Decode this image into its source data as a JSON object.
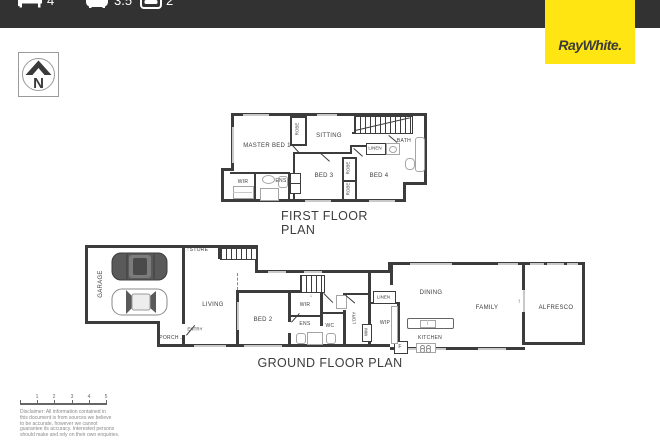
{
  "colors": {
    "top_bar": "#323232",
    "brand_yellow": "#ffe512",
    "brand_text": "#3b3b3b",
    "wall": "#3c3c3c"
  },
  "header": {
    "stats": [
      {
        "icon": "bed-icon",
        "value": "4"
      },
      {
        "icon": "bath-icon",
        "value": "3.5"
      },
      {
        "icon": "car-icon",
        "value": "2"
      }
    ],
    "brand": "RayWhite."
  },
  "compass": {
    "label": "N"
  },
  "first_floor": {
    "title": "FIRST FLOOR PLAN",
    "rooms": {
      "master_bed": "MASTER BED 1",
      "sitting": "SITTING",
      "bath": "BATH",
      "linen": "LINEN",
      "robe": "ROBE",
      "bed3": "BED 3",
      "bed4": "BED 4",
      "wir": "WIR",
      "ens": "ENS"
    }
  },
  "ground_floor": {
    "title": "GROUND FLOOR PLAN",
    "rooms": {
      "garage": "GARAGE",
      "store": "STORE",
      "living": "LIVING",
      "entry": "ENTRY",
      "porch": "PORCH",
      "bed2": "BED 2",
      "wir": "WIR",
      "ens": "ENS",
      "wc": "WC",
      "laundry": "L'DRY",
      "wm": "WM",
      "linen": "LINEN",
      "wip": "WIP",
      "fridge": "F",
      "dining": "DINING",
      "family": "FAMILY",
      "kitchen": "KITCHEN",
      "alfresco": "ALFRESCO"
    }
  },
  "icons": {
    "store_arrow": "↑",
    "porch_arrow": "→",
    "alfresco_arrow": "↑",
    "stairs_arrow": "↓"
  },
  "scale_bar": {
    "ticks": [
      "1",
      "2",
      "3",
      "4",
      "5"
    ]
  },
  "disclaimer": {
    "lines": [
      "Disclaimer: All information contained in",
      "this document is from sources we believe",
      "to be accurate, however we cannot",
      "guarantee its accuracy. Interested persons",
      "should make and rely on their own enquiries."
    ]
  }
}
